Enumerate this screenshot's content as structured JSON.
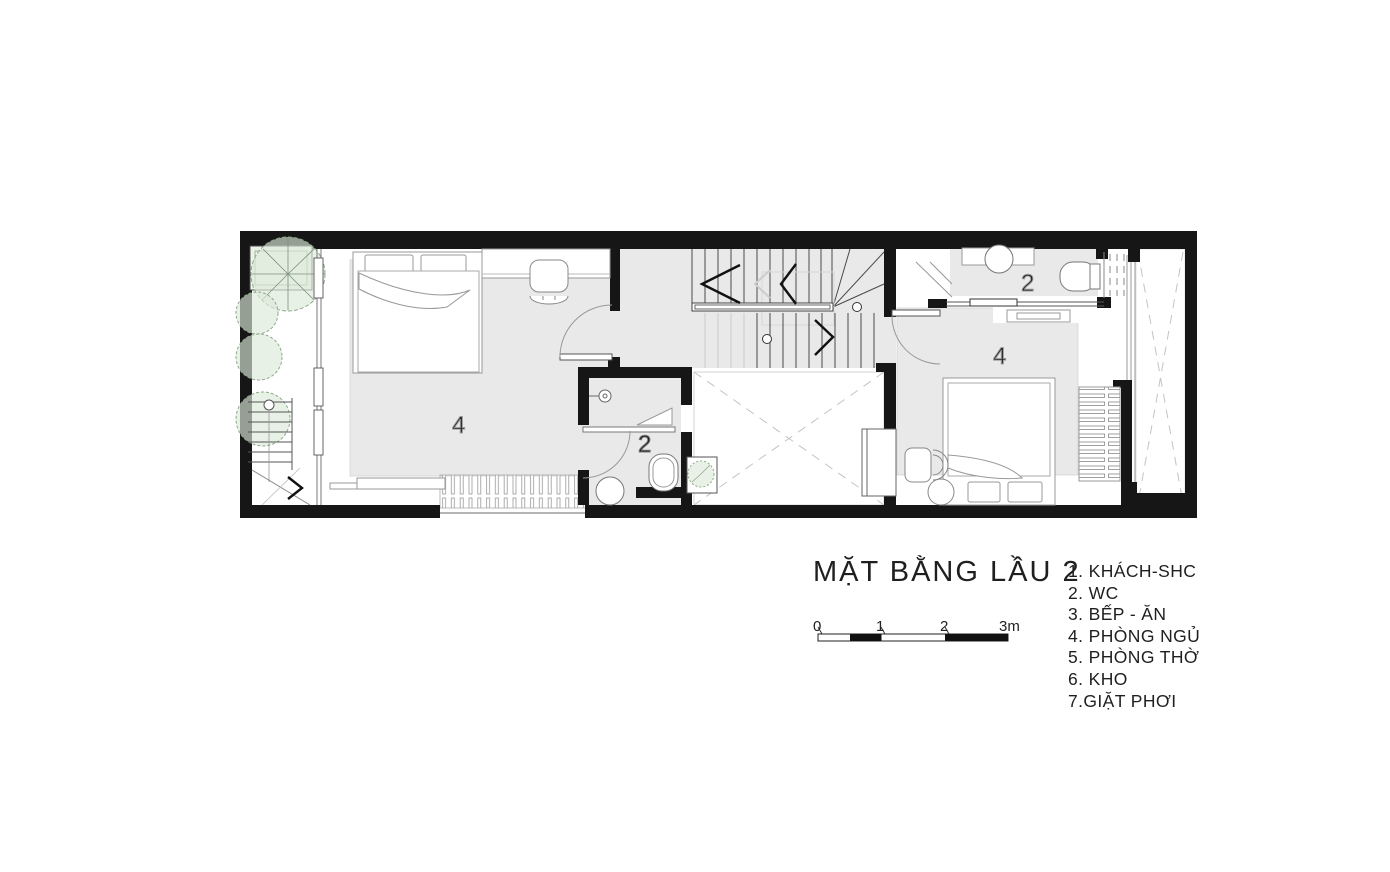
{
  "title": "MẶT BẰNG LẦU 2",
  "legend": {
    "items": [
      "1. KHÁCH-SHC",
      "2. WC",
      "3. BẾP - ĂN",
      "4. PHÒNG NGỦ",
      "5. PHÒNG THỜ",
      "6. KHO",
      "7.GIẶT PHƠI"
    ]
  },
  "scale_bar": {
    "labels": [
      "0",
      "1",
      "2",
      "3m"
    ]
  },
  "room_labels": {
    "bedroom_left": "4",
    "wc_small": "2",
    "wc_right": "2",
    "bedroom_right": "4"
  },
  "colors": {
    "wall": "#161616",
    "floor_gray": "#e9e9e9",
    "furniture_line": "#8f8f8f",
    "dash_gray": "#c4c4c4",
    "tree_fill": "#e2eedd",
    "tree_stroke": "#8fa98b",
    "text": "#1f1f1f"
  }
}
